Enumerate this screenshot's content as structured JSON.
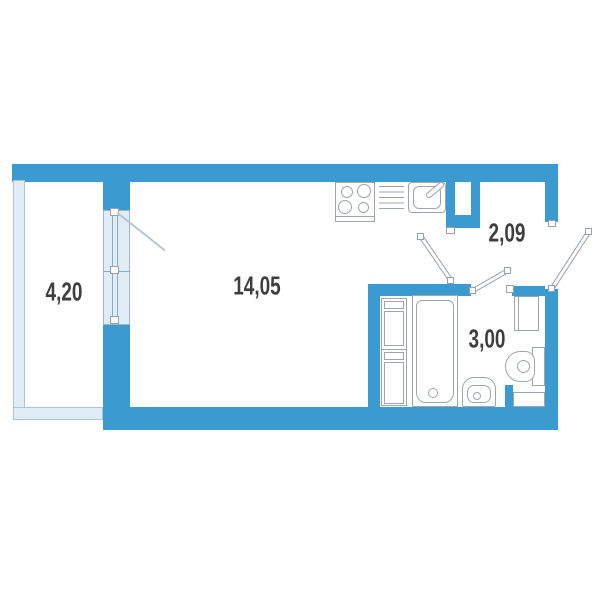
{
  "plan": {
    "title": "studio-apartment-floor-plan",
    "rooms": [
      {
        "name": "balcony",
        "area_label": "4,20"
      },
      {
        "name": "living-room",
        "area_label": "14,05"
      },
      {
        "name": "hallway",
        "area_label": "2,09"
      },
      {
        "name": "bathroom",
        "area_label": "3,00"
      }
    ],
    "fixtures": [
      "stove-4-burners",
      "drying-rack",
      "kitchen-sink-with-faucet",
      "tall-cabinet-two-sections",
      "bathtub",
      "washbasin",
      "toilet",
      "corner-cabinet",
      "balcony-window-with-door",
      "vent-niche"
    ],
    "doors": [
      {
        "name": "room-to-hallway-door"
      },
      {
        "name": "bathroom-door"
      },
      {
        "name": "entrance-door"
      },
      {
        "name": "balcony-door-swing"
      }
    ],
    "colors": {
      "wall": "#3B9BD1",
      "balcony_wall_fill": "#E0EDF7",
      "balcony_wall_border": "#AEC3D4",
      "window_fill": "#E0EDF7",
      "fixture_outline": "#9EA6AD",
      "label_text": "#3E3E3E",
      "background": "#FFFFFF"
    }
  }
}
